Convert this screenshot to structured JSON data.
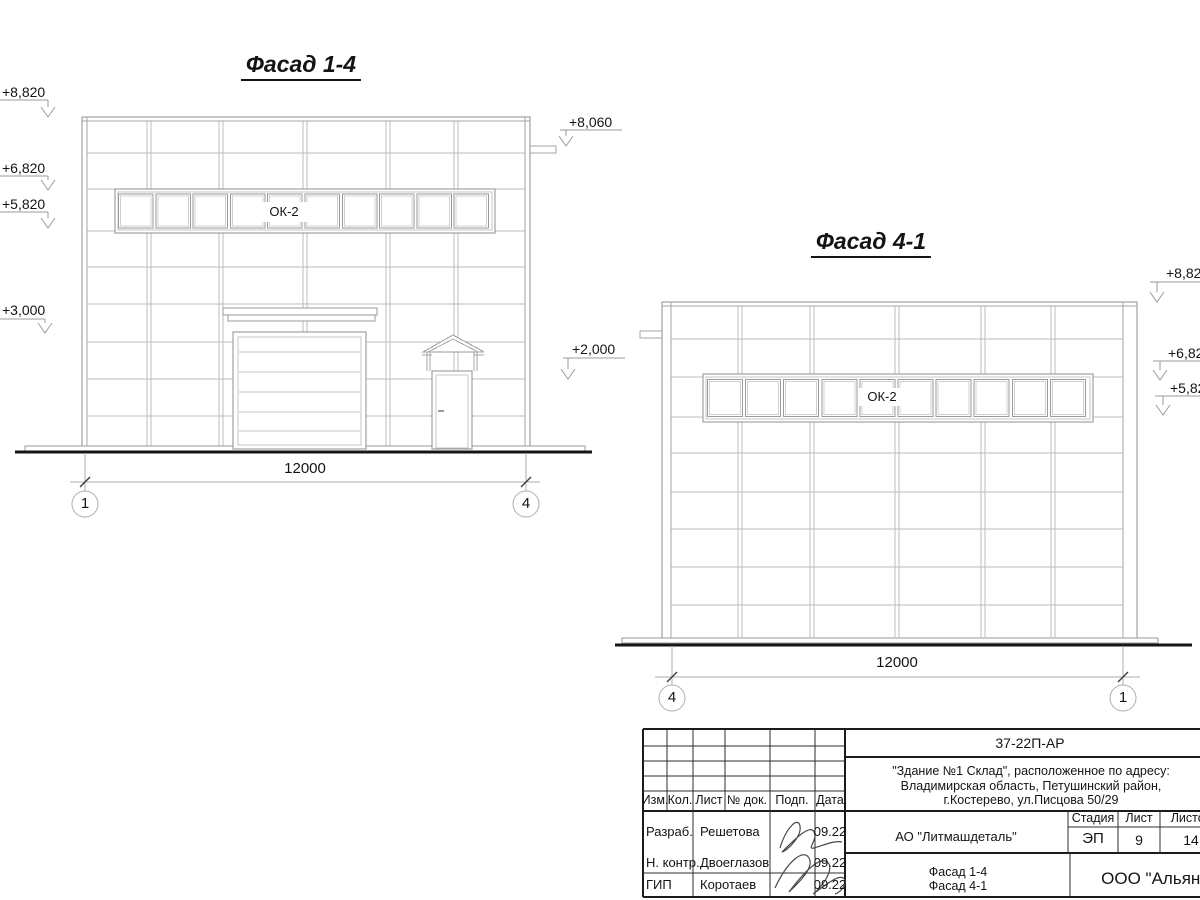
{
  "facade_1_4": {
    "title": "Фасад 1-4",
    "window_label": "ОК-2",
    "dimension": "12000",
    "axis_left": "1",
    "axis_right": "4",
    "elevations": {
      "top": "+8,820",
      "window_top": "+6,820",
      "window_bottom": "+5,820",
      "gate_canopy": "+3,000",
      "parapet_drain": "+8,060",
      "door_canopy": "+2,000"
    }
  },
  "facade_4_1": {
    "title": "Фасад 4-1",
    "window_label": "ОК-2",
    "dimension": "12000",
    "axis_left": "4",
    "axis_right": "1",
    "elevations": {
      "top": "+8,820",
      "window_top": "+6,820",
      "window_bottom": "+5,820"
    }
  },
  "title_block": {
    "doc_number": "37-22П-АР",
    "address_line1": "\"Здание №1 Склад\", расположенное по адресу:",
    "address_line2": "Владимирская область, Петушинский район,",
    "address_line3": "г.Костерево, ул.Писцова 50/29",
    "columns": {
      "izm": "Изм.",
      "kol": "Кол.",
      "list": "Лист",
      "doc": "№ док.",
      "podp": "Подп.",
      "data": "Дата"
    },
    "rows": [
      {
        "role": "Разраб.",
        "name": "Решетова",
        "date": "09.22"
      },
      {
        "role": "Н. контр.",
        "name": "Двоеглазов",
        "date": "09.22"
      },
      {
        "role": "ГИП",
        "name": "Коротаев",
        "date": "09.22"
      }
    ],
    "company": "АО \"Литмашдеталь\"",
    "stage_label": "Стадия",
    "sheet_label": "Лист",
    "sheets_label": "Листов",
    "stage": "ЭП",
    "sheet": "9",
    "sheets": "14",
    "sheet_title_line1": "Фасад 1-4",
    "sheet_title_line2": "Фасад 4-1",
    "org": "ООО \"Альянс\""
  }
}
